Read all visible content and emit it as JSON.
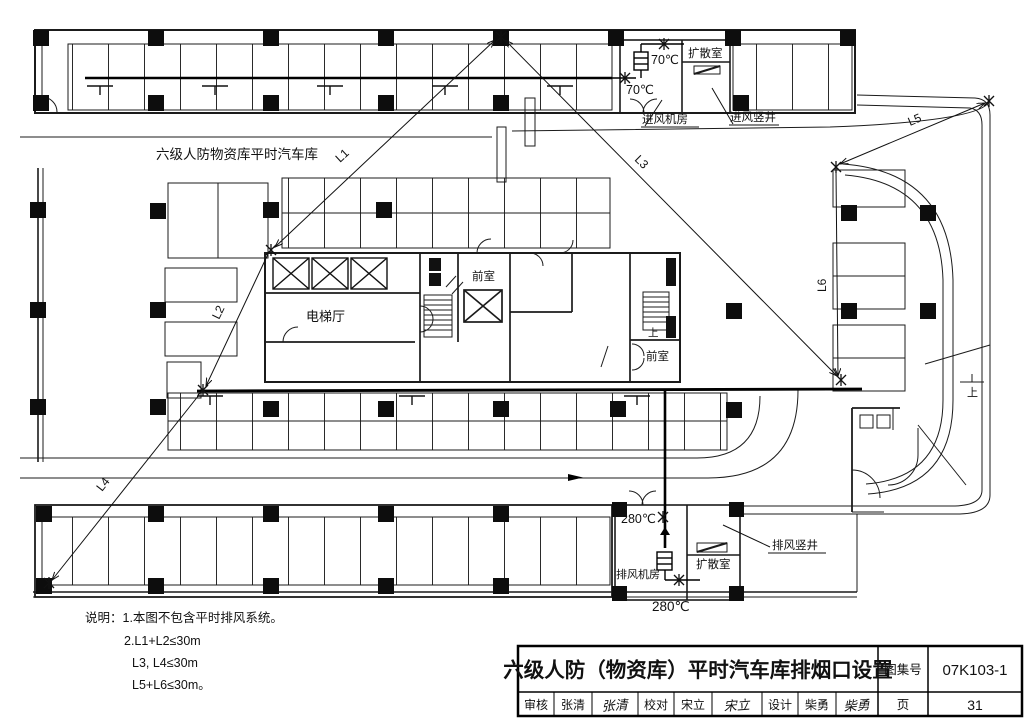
{
  "plan": {
    "area_label": "六级人防物资库平时汽车库",
    "intake": {
      "fan_room": "进风机房",
      "shaft": "进风竖井",
      "diffusion": "扩散室",
      "temp1": "70℃",
      "temp2": "70℃"
    },
    "exhaust": {
      "fan_room": "排风机房",
      "shaft": "排风竖井",
      "diffusion": "扩散室",
      "temp1": "280℃",
      "temp2": "280℃"
    },
    "core": {
      "elevator_hall": "电梯厅",
      "front_room_1": "前室",
      "front_room_2": "前室",
      "up_1": "上",
      "up_2": "上"
    },
    "measures": {
      "l1": "L1",
      "l2": "L2",
      "l3": "L3",
      "l4": "L4",
      "l5": "L5",
      "l6": "L6"
    },
    "notes": [
      "说明：1.本图不包含平时排风系统。",
      "2.L1+L2≤30m",
      "L3, L4≤30m",
      "L5+L6≤30m。"
    ]
  },
  "titleblock": {
    "title": "六级人防（物资库）平时汽车库排烟口设置",
    "atlas_label": "图集号",
    "atlas_no": "07K103-1",
    "page_label": "页",
    "page_no": "31",
    "review_label": "审核",
    "review_name": "张清",
    "review_sig": "张清",
    "proof_label": "校对",
    "proof_name": "宋立",
    "proof_sig": "宋立",
    "design_label": "设计",
    "design_name": "柴勇",
    "design_sig": "柴勇"
  }
}
